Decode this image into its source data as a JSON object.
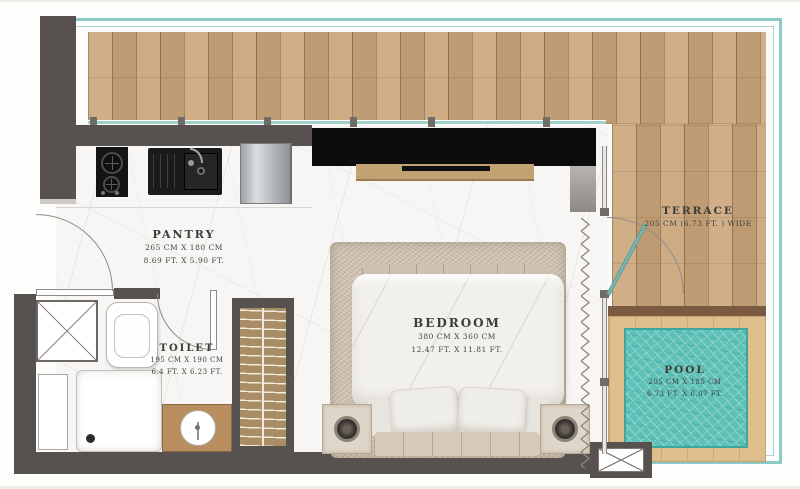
{
  "rooms": {
    "pantry": {
      "name": "PANTRY",
      "size_cm": "265 CM X 180 CM",
      "size_ft": "8.69 FT. X 5.90 FT."
    },
    "toilet": {
      "name": "TOILET",
      "size_cm": "195 CM X 190 CM",
      "size_ft": "6.4 FT. X 6.23 FT."
    },
    "bedroom": {
      "name": "BEDROOM",
      "size_cm": "380 CM X 360 CM",
      "size_ft": "12.47 FT. X 11.81 FT."
    },
    "terrace": {
      "name": "TERRACE",
      "size_cm": "205 CM (6.73 FT. ) WIDE"
    },
    "pool": {
      "name": "POOL",
      "size_cm": "205 CM X 185 CM",
      "size_ft": "6.73 FT. X 6.07 FT."
    }
  },
  "colors": {
    "wall": "#57514f",
    "deck_wood": "#c8a47b",
    "pool_deck": "#debe8d",
    "pool_water": "#5ec1b7",
    "glass_balustrade": "#8ccac5",
    "curtain": "#8d867f",
    "rug": "#cbbfae"
  }
}
